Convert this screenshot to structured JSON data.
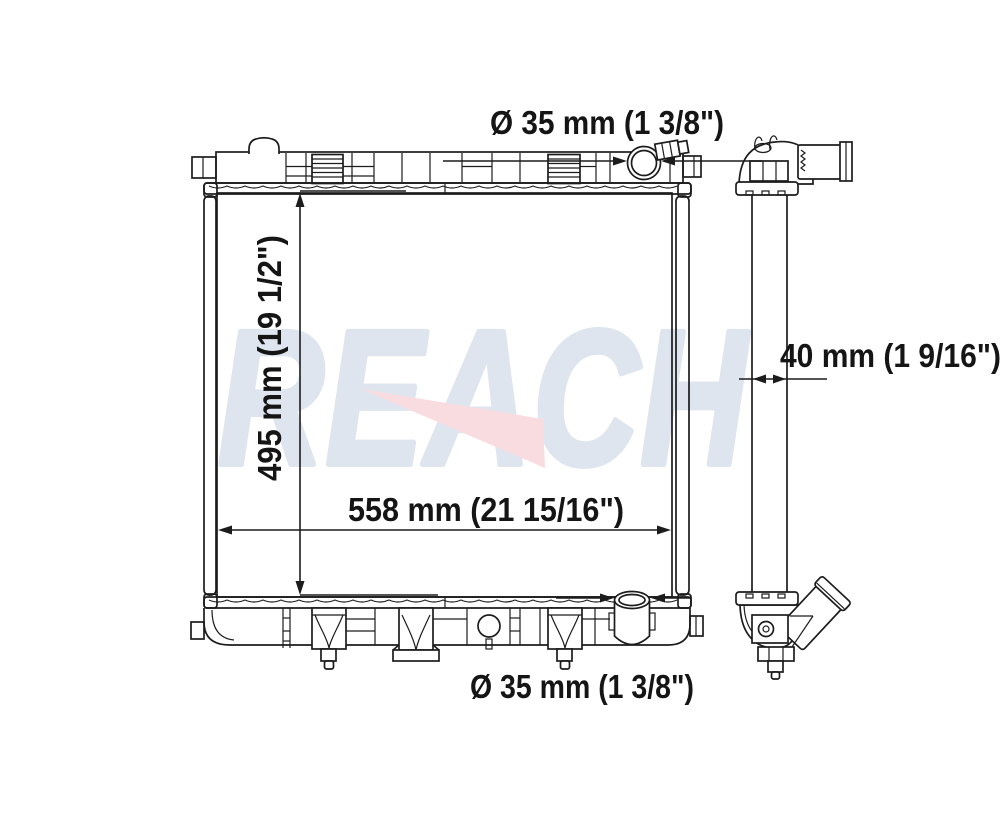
{
  "colors": {
    "background": "#ffffff",
    "line": "#1c1c1c",
    "watermark_text": "#dfe5ee",
    "watermark_arrow": "#f8dce0"
  },
  "watermark": {
    "brand": "REACH"
  },
  "annotations": {
    "top_port_diameter": "Ø 35 mm (1 3/8\")",
    "core_height": "495 mm (19 1/2\")",
    "core_width": "558 mm (21 15/16\")",
    "core_depth": "40 mm (1 9/16\")",
    "bottom_port_diameter": "Ø 35 mm (1 3/8\")"
  }
}
